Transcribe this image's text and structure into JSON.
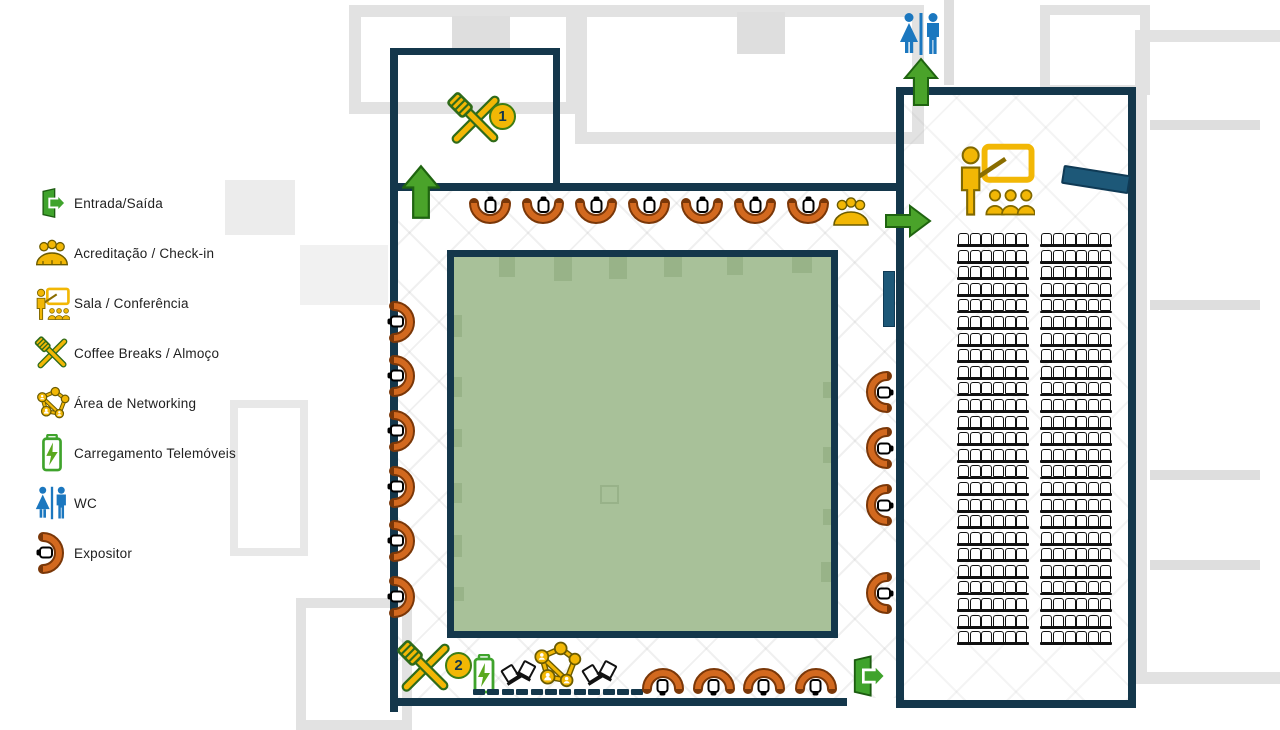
{
  "title": "Planta do Evento",
  "legend": {
    "items": [
      {
        "icon": "entrance-exit-icon",
        "label": "Entrada/Saída"
      },
      {
        "icon": "checkin-icon",
        "label": "Acreditação / Check-in"
      },
      {
        "icon": "conference-icon",
        "label": "Sala / Conferência"
      },
      {
        "icon": "coffee-break-icon",
        "label": "Coffee Breaks / Almoço"
      },
      {
        "icon": "networking-icon",
        "label": "Área de Networking"
      },
      {
        "icon": "phone-charging-icon",
        "label": "Carregamento Telemóveis"
      },
      {
        "icon": "wc-icon",
        "label": "WC"
      },
      {
        "icon": "exhibitor-icon",
        "label": "Expositor"
      }
    ]
  },
  "plan": {
    "coffee1_badge": "1",
    "coffee2_badge": "2",
    "seating": {
      "rows": 25,
      "blocks": 2,
      "seats_per_block": 6
    },
    "expositors": {
      "top": 7,
      "left": 6,
      "right": 4,
      "bottom": 4
    },
    "tables_count": 12,
    "networking_chairs": 4,
    "colors": {
      "wall_navy": "#14374b",
      "expositor_orange": "#d2691f",
      "expositor_outline": "#7a3708",
      "arrow_green": "#4aa32a",
      "accent_yellow": "#f2b705",
      "wc_blue": "#1b77bf",
      "podium_blue": "#1d5878",
      "courtyard_green": "#a8c199"
    }
  }
}
